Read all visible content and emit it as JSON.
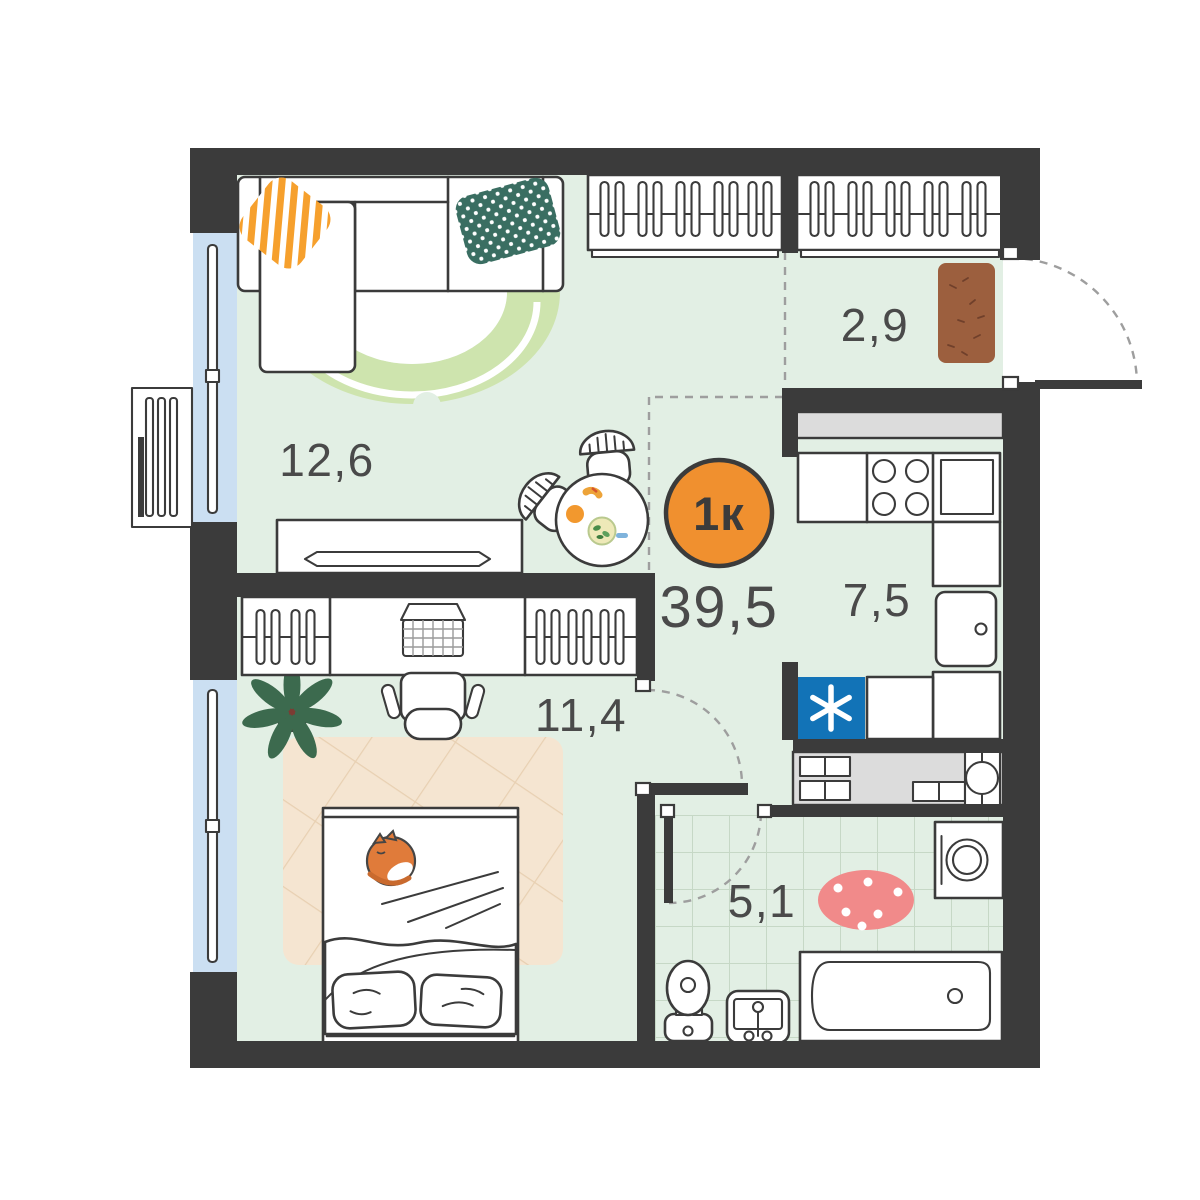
{
  "badge": {
    "type_label": "1к"
  },
  "total_area": "39,5",
  "rooms": {
    "living": {
      "area": "12,6"
    },
    "bedroom": {
      "area": "11,4"
    },
    "hallway": {
      "area": "2,9"
    },
    "kitchen": {
      "area": "7,5"
    },
    "bathroom": {
      "area": "5,1"
    }
  },
  "colors": {
    "wall": "#3b3b3b",
    "floor": "#e2efe4",
    "window-glass": "#cbdff2",
    "tile-line": "#c6d8c6",
    "dash-gray": "#9e9e9e",
    "label": "#4a4a4a",
    "accent-orange": "#f0902f",
    "rug-green": "#cee4ae",
    "pillow-orange": "#f6a02d",
    "pillow-teal": "#3a6e62",
    "doormat-brown": "#9c5f3e",
    "doormat-speckle": "#70402b",
    "rug-beige": "#f5e5d1",
    "rug-beige-line": "#e8d0b2",
    "rug-pink": "#f18a8a",
    "appliance-blue": "#1273b7",
    "counter-gray": "#dcdcdc",
    "cat-orange": "#e07b3a",
    "plant-green": "#3c6a4e",
    "pot-brown": "#7c3c33"
  }
}
